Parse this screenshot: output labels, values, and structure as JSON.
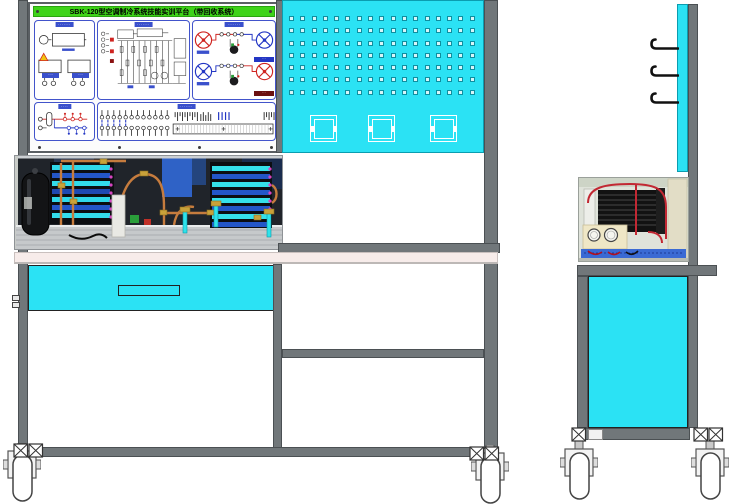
{
  "title": "SBK-120型空调制冷系统技能实训平台（带回收系统）",
  "colors": {
    "titleGreen": "#3ed318",
    "cyan": "#2be2f4",
    "frame": "#71777a",
    "frameDark": "#4b5053",
    "benchTop": "#f7ecea",
    "panelBorder": "#4254cb",
    "labelBg": "#3a50cc",
    "red": "#cf2420",
    "blue": "#2336c4",
    "copper": "#c67c3e",
    "brass": "#c9a23a"
  },
  "board": {
    "panels": {
      "power": {
        "label": "·······",
        "meter1_label": "····",
        "meter2_label": "····"
      },
      "schematic": {
        "label": "·······"
      },
      "refrigeration": {
        "label": "·······",
        "row1_badge": "···",
        "row2_badge": "···"
      },
      "piping": {
        "label": "····"
      },
      "terminals": {
        "label": "·······",
        "switch_columns": 12,
        "strip_slots": 31
      }
    }
  },
  "pegboard": {
    "rows": 7,
    "cols": 17,
    "fixtures": 3
  },
  "front": {
    "casters": 2
  },
  "side": {
    "hooks": 3,
    "casters": 2
  }
}
